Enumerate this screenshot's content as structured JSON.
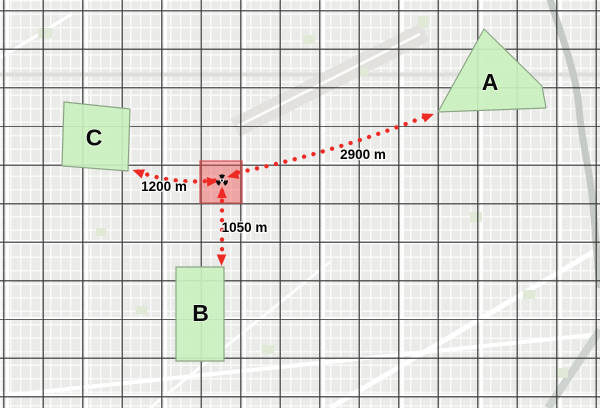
{
  "zones": [
    {
      "id": "zone-a",
      "label": "A",
      "distance_label": "2900 m",
      "distance_m": 2900
    },
    {
      "id": "zone-b",
      "label": "B",
      "distance_label": "1050 m",
      "distance_m": 1050
    },
    {
      "id": "zone-c",
      "label": "C",
      "distance_label": "1200 m",
      "distance_m": 1200
    }
  ],
  "incident": {
    "marker_icon": "radiation-icon",
    "shape": "translucent-red-square"
  },
  "colors": {
    "arrow": "#EE2A24",
    "zone_fill": "#C9F0BE",
    "zone_border": "#8CA685",
    "incident_fill": "#F04646",
    "incident_border": "#CD4B4B",
    "graticule": "#3E3E3E",
    "basemap": "#EAEAE8",
    "street": "#FFFFFF",
    "park": "#DFE9D6",
    "water_rail": "#C6CAC6",
    "label_text": "#000000"
  }
}
